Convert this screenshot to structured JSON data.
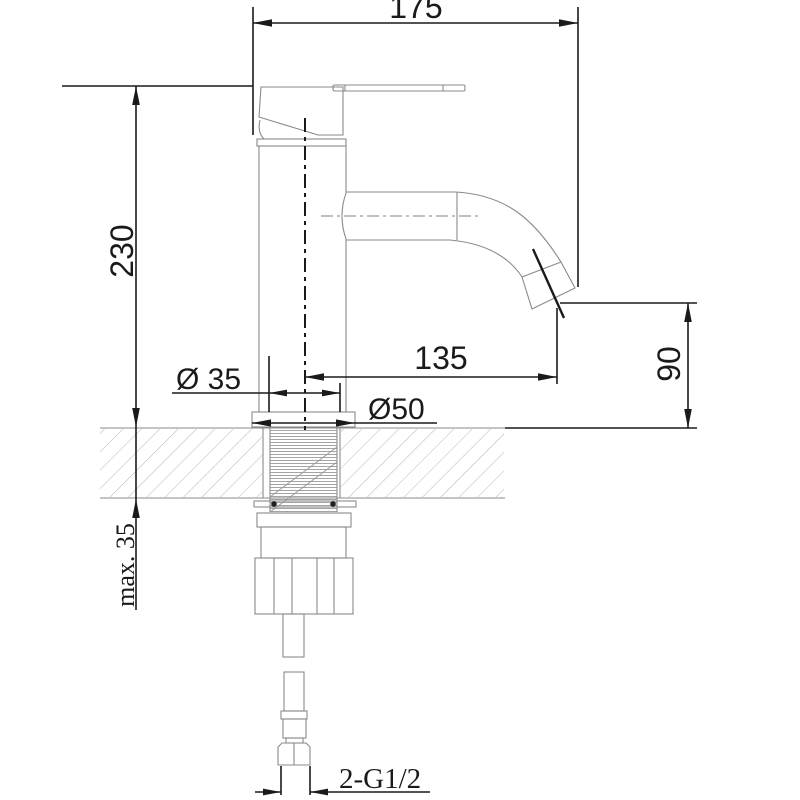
{
  "drawing": {
    "subject": "single-lever-basin-faucet-side-view",
    "dims": {
      "overall_depth": "175",
      "overall_height": "230",
      "spout_reach": "135",
      "spout_outlet_height": "90",
      "shank_diameter": "Ø 35",
      "base_diameter": "Ø50",
      "max_mounting_thickness": "max. 35",
      "inlet_thread": "2-G1/2"
    },
    "colors": {
      "dimension_line": "#1a1a1a",
      "body_line": "#8a8a8a",
      "hatch_line": "#b5b5b5",
      "thread_line": "#9a9a9a",
      "background": "#ffffff"
    }
  }
}
